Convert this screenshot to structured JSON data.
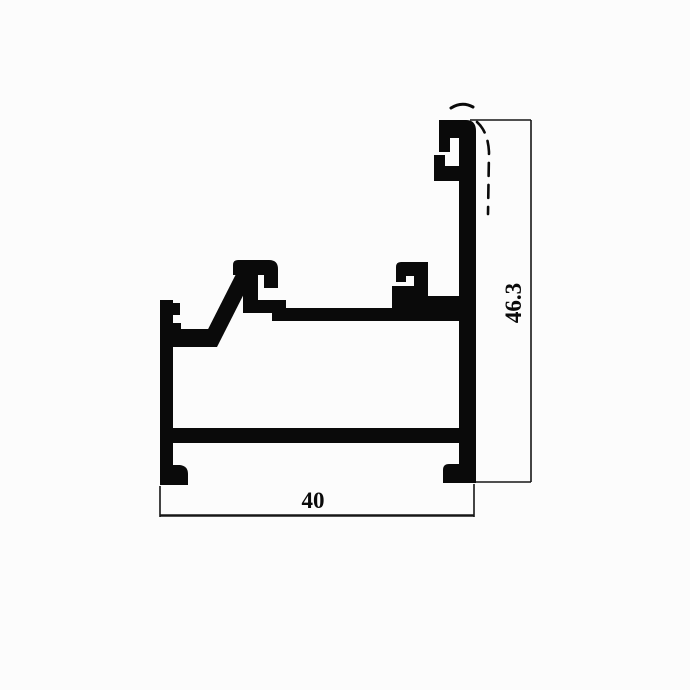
{
  "drawing": {
    "type": "aluminium-profile-cross-section",
    "dimensions": {
      "width_label": "40",
      "height_label": "46.3"
    }
  },
  "canvas": {
    "background": "#fcfcfc",
    "ink": "#0a0a0a",
    "dimension_line_color": "#161616"
  }
}
